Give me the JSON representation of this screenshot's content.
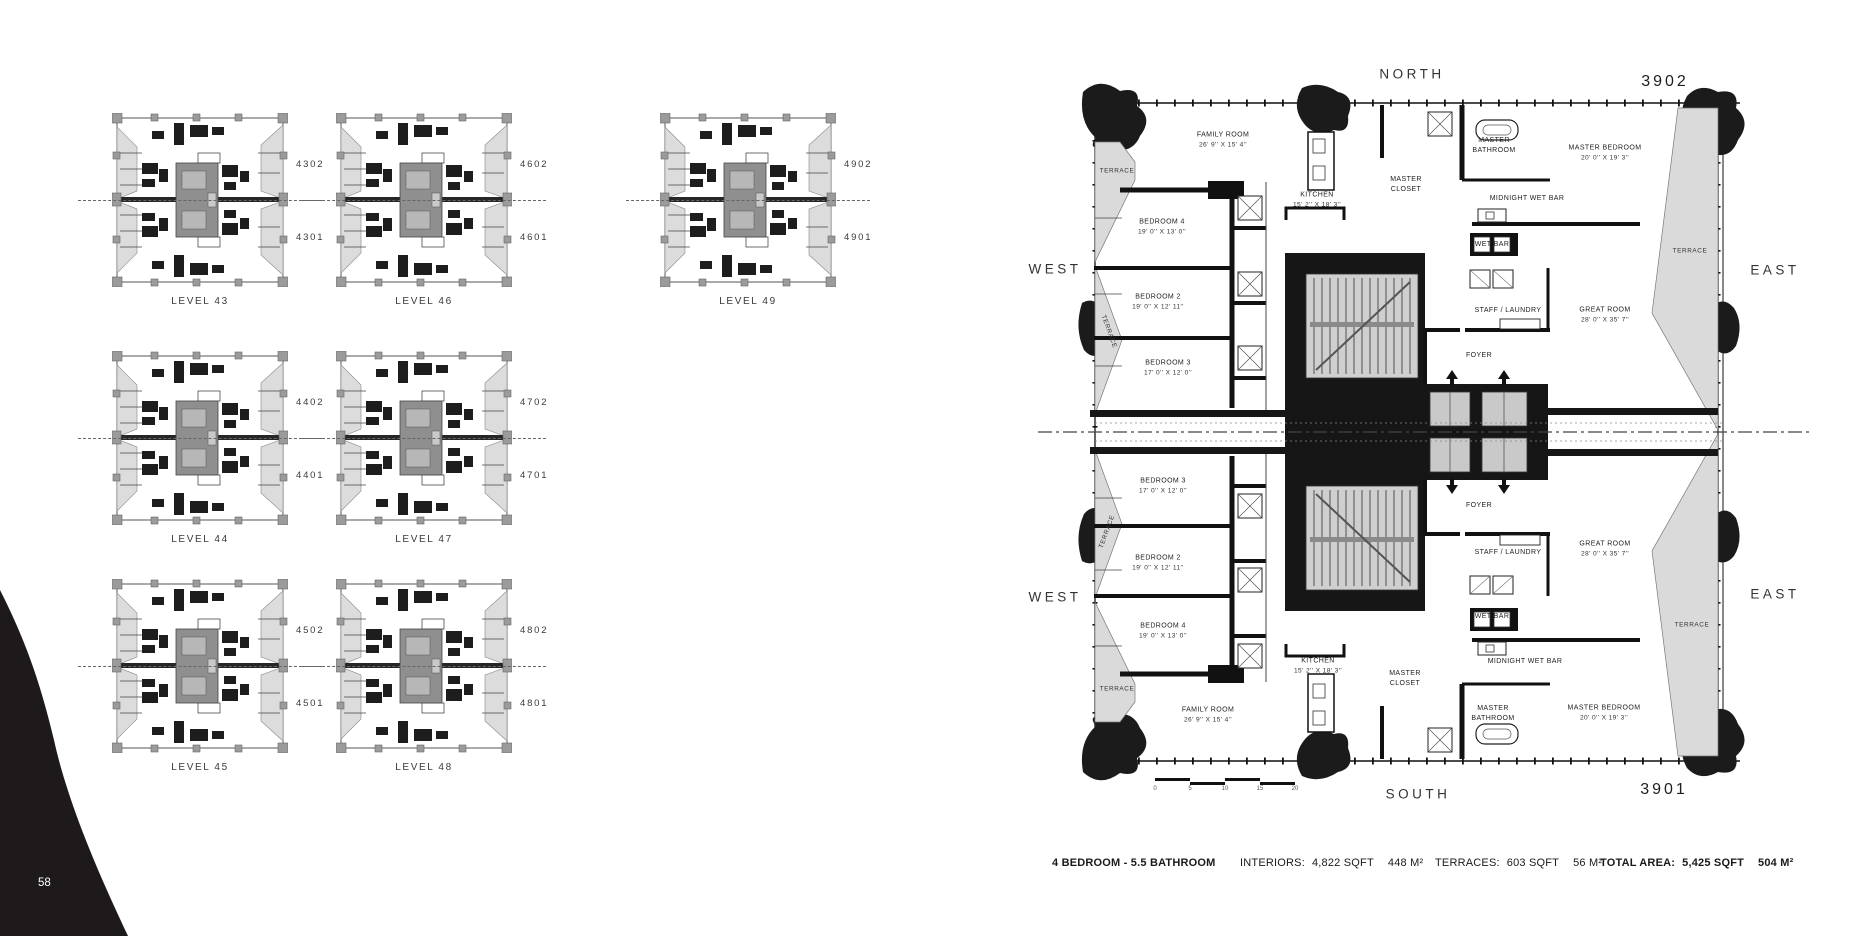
{
  "page": {
    "number": "58"
  },
  "levels": {
    "thumbnails": [
      {
        "level": "LEVEL 43",
        "unit_top": "4302",
        "unit_bottom": "4301"
      },
      {
        "level": "LEVEL 46",
        "unit_top": "4602",
        "unit_bottom": "4601"
      },
      {
        "level": "LEVEL 49",
        "unit_top": "4902",
        "unit_bottom": "4901"
      },
      {
        "level": "LEVEL 44",
        "unit_top": "4402",
        "unit_bottom": "4401"
      },
      {
        "level": "LEVEL 47",
        "unit_top": "4702",
        "unit_bottom": "4701"
      },
      {
        "level": "LEVEL 45",
        "unit_top": "4502",
        "unit_bottom": "4501"
      },
      {
        "level": "LEVEL 48",
        "unit_top": "4802",
        "unit_bottom": "4801"
      }
    ]
  },
  "plan": {
    "compass": {
      "north": "NORTH",
      "south": "SOUTH",
      "west": "WEST",
      "east": "EAST"
    },
    "unit_north": "3902",
    "unit_south": "3901",
    "rooms": {
      "family_room": {
        "name": "FAMILY ROOM",
        "dims": "26' 9'' X 15' 4''"
      },
      "kitchen": {
        "name": "KITCHEN",
        "dims": "15' 2'' X 18' 3''"
      },
      "master_closet": {
        "name": "MASTER CLOSET"
      },
      "master_bathroom": {
        "name": "MASTER BATHROOM"
      },
      "master_bedroom": {
        "name": "MASTER BEDROOM",
        "dims": "20' 0'' X 19' 3''"
      },
      "midnight_wet_bar": {
        "name": "MIDNIGHT WET BAR"
      },
      "wet_bar": {
        "name": "WET BAR"
      },
      "staff_laundry": {
        "name": "STAFF / LAUNDRY"
      },
      "foyer": {
        "name": "FOYER"
      },
      "great_room": {
        "name": "GREAT ROOM",
        "dims": "28' 0'' X 35' 7''"
      },
      "bedroom_2": {
        "name": "BEDROOM 2",
        "dims": "19' 0'' X 12' 11''"
      },
      "bedroom_3": {
        "name": "BEDROOM 3",
        "dims": "17' 0'' X 12' 0''"
      },
      "bedroom_4": {
        "name": "BEDROOM 4",
        "dims": "19' 0'' X 13' 0''"
      },
      "terrace": {
        "name": "TERRACE"
      }
    },
    "scale_bar": {
      "ticks": [
        "0",
        "5",
        "10",
        "15",
        "20"
      ]
    }
  },
  "footer": {
    "configuration": "4 BEDROOM - 5.5 BATHROOM",
    "interiors_label": "INTERIORS:",
    "interiors_sqft": "4,822 SQFT",
    "interiors_m2": "448 M²",
    "terraces_label": "TERRACES:",
    "terraces_sqft": "603 SQFT",
    "terraces_m2": "56 M²",
    "total_label": "TOTAL AREA:",
    "total_sqft": "5,425 SQFT",
    "total_m2": "504 M²"
  }
}
